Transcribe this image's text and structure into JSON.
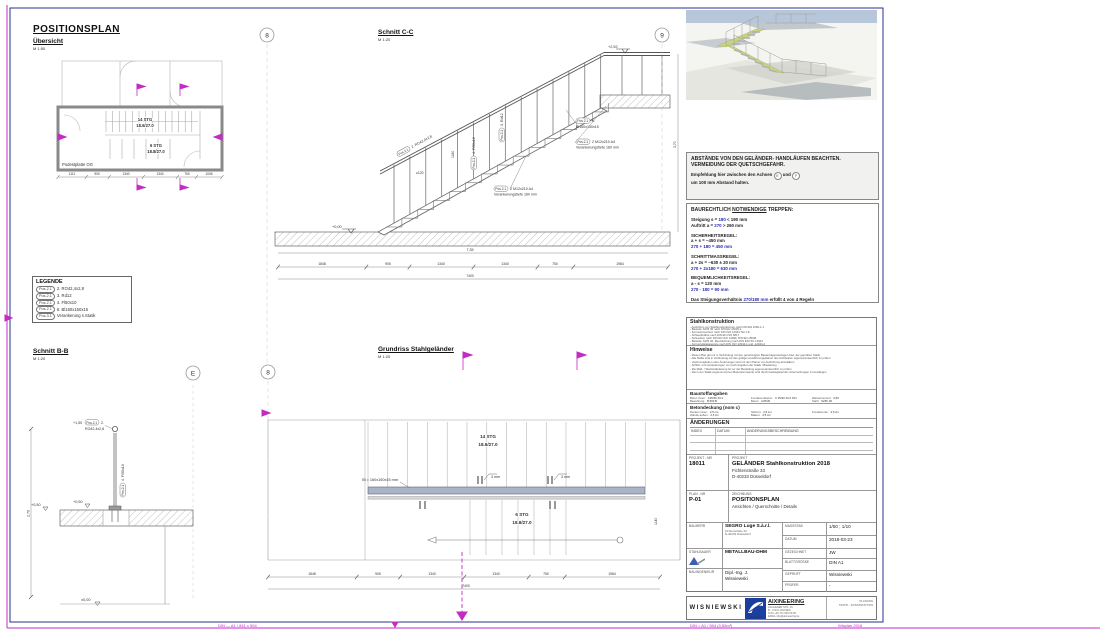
{
  "frame": {
    "bottom_left2": "DIN — A1 / 841 x 594",
    "bottom_left": "DIN = A1 / 594 (0,50m²)",
    "bottom_right": "Wisplan 2018"
  },
  "axes": {
    "top_left": "8",
    "top_right": "9",
    "bb_right": "E",
    "gr_left": "8"
  },
  "uebersicht": {
    "title": "POSITIONSPLAN",
    "subtitle": "Übersicht",
    "scale": "M 1:50",
    "stg14": "14 STG",
    "stg14v": "18.6/27.0",
    "stg6": "6 STG",
    "stg6v": "18.8/27.0",
    "podest": "Podestplatte OG",
    "dims": [
      "1111",
      "900",
      "1340",
      "1340",
      "750",
      "1006"
    ]
  },
  "legend": {
    "title": "LEGENDE",
    "items": [
      {
        "pos": "Pos.2.1",
        "text": "2. RO42,4x2,8"
      },
      {
        "pos": "Pos.2.1",
        "text": "3. Rd12"
      },
      {
        "pos": "Pos.2.1",
        "text": "4. Fl50x10"
      },
      {
        "pos": "Pos.2.1",
        "text": "6. Bl160x150x15"
      },
      {
        "pos": "Pos.3.1",
        "text": "Verankerung s.Statik"
      }
    ]
  },
  "schnitt_cc": {
    "title": "Schnitt C-C",
    "scale": "M 1:20",
    "pos": "Pos.2.1",
    "c_rail": "2. RO42,4x2,8",
    "c_rd": "3. Rd12",
    "c_fl": "4. Fl50x10",
    "c_bl_a": "6.",
    "c_bl_b": "Bl160x150x15",
    "c_anchor1": "2 M12x210 A4",
    "c_anchor2": "Verankerungstiefe 160 mm",
    "lvl0": "+0,00",
    "lvl_top": "+2,52",
    "dim_1180": "1180",
    "dim_120": "≥120",
    "dim_r": "3,70",
    "span": "7,35",
    "dims": [
      "1848",
      "905",
      "1340",
      "1340",
      "750",
      "1984"
    ],
    "total": "7400"
  },
  "schnitt_bb": {
    "title": "Schnitt B-B",
    "scale": "M 1:20",
    "lvl_top": "+1,50",
    "lvl_g1": "+0,50",
    "lvl_g2": "+0,50",
    "lvl_0": "±0,00",
    "dim": "2,70",
    "pos": "Pos.2.1",
    "c1a": "2.",
    "c1b": "RO42,4x2,8",
    "c2": "4. Fl50x10"
  },
  "grundriss": {
    "title": "Grundriss Stahlgeländer",
    "scale": "M 1:20",
    "stg14": "14 STG",
    "stg14v": "18.6/27.0",
    "stg6": "6 STG",
    "stg6v": "18.8/27.0",
    "weld1": "3 mm",
    "weld2": "3 mm",
    "plate": "Bl = 160x150x15 mm",
    "vdim": "1140",
    "dims": [
      "1848",
      "905",
      "1340",
      "1340",
      "750",
      "1984"
    ],
    "total": "7400"
  },
  "warning": {
    "l1": "ABSTÄNDE VON DEN GELÄNDER- HANDLÄUFEN BEACHTEN.",
    "l2": "VERMEIDUNG DER QUETSCHGEFAHR.",
    "l3a": "Empfehlung hier zwischen den Achsen",
    "ax1": "E",
    "mid": "und",
    "ax2": "F",
    "l4": "um 100 mm Abstand halten."
  },
  "rules": {
    "t1": "BAURECHTLICH",
    "t2": "NOTWENDIGE",
    "t3": "TREPPEN:",
    "r1_pre": "Steigung s = ",
    "r1_em": "180",
    "r1_post": " < 190 mm",
    "r2_pre": "Auftritt a = ",
    "r2_em": "270",
    "r2_post": " > 260 mm",
    "h1": "SICHERHEITSREGEL:",
    "s1": "a + s = ~450 mm",
    "s1b": "270 + 180 = 450 mm",
    "h2": "SCHRITTMASSREGEL:",
    "s2": "a + 2s = ~630 ± 20 mm",
    "s2b": "270 + 2x180 = 630 mm",
    "h3": "BEQUEMLICHKEITSREGEL:",
    "s3": "a - s = 120 mm",
    "s3b": "270 - 180 = 90 mm",
    "f_pre": "Das Steigungsverhältnis ",
    "f_em": "270/180 mm",
    "f_post": " erfüllt 4 von 4 Regeln"
  },
  "tb": {
    "s1_title": "Stahlkonstruktion",
    "s1_lines": [
      "- Ausführen von Stahlkonstruktionen nach DIN EN 1090-1-1",
      "- Bauteile S235 JR nach DIN EN 10025-1",
      "- Korrosionsschutz nach DIN ISO 12944 Teil 1-8",
      "- Schweißnähte nach DIN EN ISO 5817",
      "- Schrauben nach DIN EN ISO 14399, DIN EN 15048",
      "- Bauteile S235 JR, Beschichtung nach DIN EN ISO 12944",
      "- Korrosivitätskategorie nach DIN ISO 12944-1 und -12944-2"
    ],
    "s2_title": "Hinweise",
    "s2_lines": [
      "- Dieser Plan gilt nur in Verbindung mit den genehmigten Bauantragsunterlagen bzw. der geprüften Statik",
      "- Alle Maße sind in Verbindung mit den gültigen Ausführungsplänen des Architekten eigenverantwortlich zu prüfen",
      "- Unstimmigkeiten oder Änderungen sind mit dem Planer vor Ausführung abzuklären",
      "- Schlitz- und Aussparungen nur nach Angaben der Statik / Bauleitung",
      "- Die Maß- / Werkstattplanung ist vor der Bestellung eigenverantwortlich zu prüfen",
      "- Die in der Statik angenommenen Bodenkennwerte sind durch baubegleitende Untersuchungen zu bestätigen"
    ],
    "s3_title": "Baustoffangaben",
    "s3_rows": [
      [
        {
          "l": "Beton innen:",
          "v": "C25/30 XC1"
        },
        {
          "l": "Fundamentbeton:",
          "v": "C 25/30 XC2 XF1"
        },
        {
          "l": "Wasserzement:",
          "v": "0,50"
        }
      ],
      [
        {
          "l": "Bewehrung:",
          "v": "B 500 B"
        },
        {
          "l": "Beton:",
          "v": "C25/30"
        },
        {
          "l": "Stahl:",
          "v": "S235 JR"
        }
      ]
    ],
    "s4_title": "Betondeckung  (nom c)",
    "s4_rows": [
      [
        {
          "l": "Decken innen:",
          "v": "2,5 cm"
        },
        {
          "l": "Stützen:",
          "v": "2,5 cm"
        },
        {
          "l": "Fundamente:",
          "v": "3,5 cm"
        }
      ],
      [
        {
          "l": "Wände außen:",
          "v": "2,5 cm"
        },
        {
          "l": "Balken:",
          "v": "2,5 cm"
        },
        {
          "l": "",
          "v": ""
        }
      ]
    ],
    "s5_title": "ÄNDERUNGEN",
    "s5_headers": [
      "INDEX",
      "DATUM",
      "ÄNDERUNGSBESCHREIBUNG"
    ],
    "projekt_nr_label": "PROJEKT - NR",
    "projekt_nr": "18011",
    "projekt_label": "PROJEKT",
    "projekt_name": "GELÄNDER Stahlkonstruktion 2018",
    "projekt_addr1": "Fichtenstraße 33",
    "projekt_addr2": "D-40233 Düsseldorf",
    "plan_nr_label": "PLAN - NR",
    "plan_nr": "P-01",
    "zeichnung_label": "ZEICHNUNG",
    "zeichnung_name": "POSITIONSPLAN",
    "zeichnung_sub": "Ansichten / Querschnitte / Details",
    "bauherr_label": "BAUHERR",
    "bauherr_name": "SEGRO Luge S.à.r.l.",
    "bauherr_a1": "Fichtenstraße 33",
    "bauherr_a2": "D-40233 Düsseldorf",
    "massstab_label": "MASSSTAB",
    "massstab": "1/50 ; 1/10",
    "datum_label": "DATUM",
    "datum": "2018-03-23",
    "stahlbauer_label": "STAHLBAUER",
    "stahlbauer": "METALLBAU-DHM",
    "gezeichnet_label": "GEZEICHNET",
    "gezeichnet": "JW",
    "blatt_label": "BLATTGRÖSSE",
    "blatt": "DIN A1",
    "bauing_label": "BAUINGENIEUR",
    "bauing1": "Dipl.-Ing. J.",
    "bauing2": "Wisniewski",
    "geprueft_label": "GEPRÜFT",
    "geprueft": "Wisniewski",
    "pruefer_label": "PRÜFER",
    "pruefer": "-"
  },
  "footer": {
    "firm1": "WISNIEWSKI",
    "logo_caption": "AIXINEERING",
    "firm2": "AIXINEERING",
    "addr": [
      "AACHENER STR. 19",
      "B - 4710 LONTZEN",
      "FON +49 171 000 00 00",
      "EMAIL  info@aixineering.be"
    ],
    "right1": "PLANUNG",
    "right2": "STATIK - KONSTRUKTION"
  },
  "colors": {
    "magenta": "#c32cc3",
    "navy": "#2b2f8e",
    "blue_text": "#2a2ab8",
    "rail_band": "#a9b4c7",
    "stringer_green": "#c9d37f",
    "sky": "#b7c7d9"
  }
}
